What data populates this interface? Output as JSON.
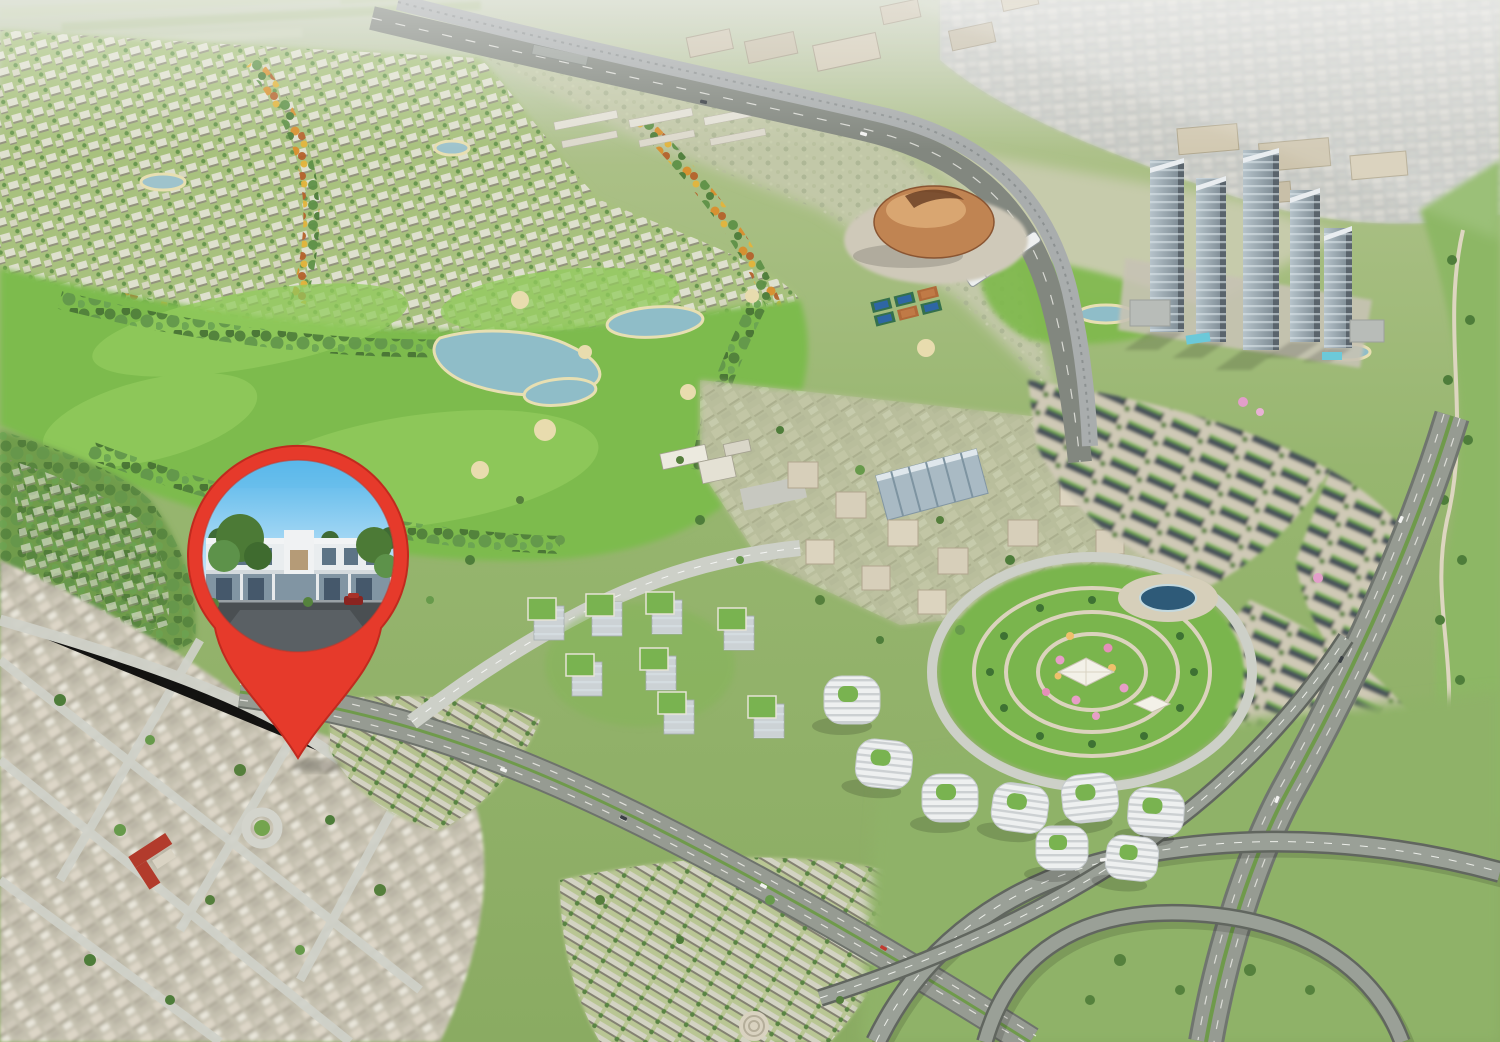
{
  "scene": {
    "type": "aerial-masterplan-render",
    "description": "Bird's-eye 3D render of a master-planned golf community: villa districts and golf fairways with lakes upper-left, a copper-domed arena with tennis courts and a glass high-rise cluster upper-right, a circular central park ringed by dark mid-rise apartment rows, white curved towers and a green-roof tower cluster in the centre, a metro rail line, dense low-rise districts lower-left and a motorway interchange lower-right. A red map pin with a townhouse photo inset marks a location left of centre.",
    "landmarks": [
      "villa-suburbs",
      "golf-course",
      "golf-lakes",
      "sand-bunkers",
      "clubhouse",
      "stadium-arena",
      "tennis-courts",
      "glass-tower-cluster",
      "rooftop-pools",
      "metro-rail-line",
      "metro-train",
      "town-centre-blocks",
      "blue-roof-warehouse",
      "green-roof-tower-cluster",
      "white-curved-towers",
      "circular-park",
      "park-pond",
      "park-tent",
      "midrise-apartment-rows",
      "bottom-left-district",
      "roundabout",
      "red-roof-building",
      "central-motorway",
      "edge-motorway",
      "highway-interchange",
      "amphitheatre",
      "location-pin"
    ]
  },
  "marker": {
    "name": "location-pin",
    "pin_red": "#e63a2b",
    "pin_rim": "#c02a1e",
    "inset_photo": "two-storey modern townhouse row with glass facades, trees and a driveway with a parked red car"
  },
  "colors": {
    "grass_base": "#96b56c",
    "haze_top": "#cdd3c1",
    "golf_green": "#7dbb4d",
    "fairway_light": "#93cc5e",
    "lake_blue": "#8fbdc8",
    "sand_beige": "#e8dcae",
    "stadium_copper": "#c08452",
    "stadium_plaza": "#cfc9b9",
    "tower_glass_light": "#b6c3ca",
    "tower_glass_dark": "#77858e",
    "white_tower": "#eef0f0",
    "green_roof": "#79b350",
    "midrise_dark": "#49525a",
    "urban_beige": "#d9d3c4",
    "road_light": "#cdd0c8",
    "motorway_grey": "#969b92",
    "ramp_grey": "#9aa097",
    "rail_grey": "#a9adad",
    "pond_blue": "#2e5a78",
    "umbrella_pink": "#e79ec7",
    "photo_sky": "#64bdec",
    "photo_asphalt": "#4a4f52",
    "photo_house": "#e9edef",
    "photo_glass": "#8195a3"
  }
}
